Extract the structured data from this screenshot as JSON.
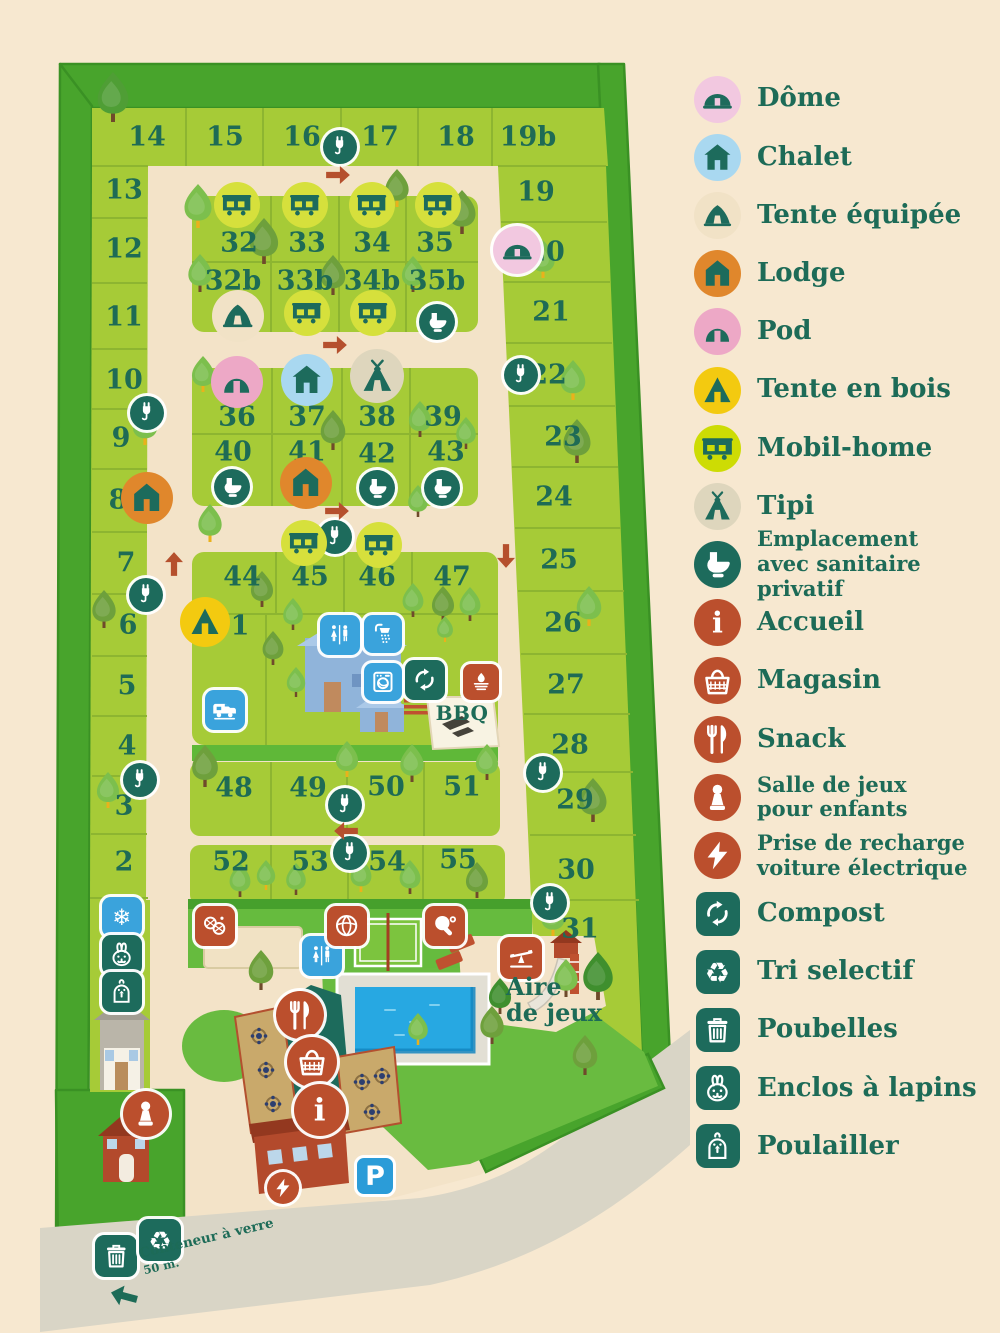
{
  "colors": {
    "page_bg": "#f7e8d0",
    "hedge": "#48a42c",
    "plot_green": "#a6cb37",
    "lawn": "#69bb40",
    "path": "#f3e3c8",
    "road": "#d9d5c6",
    "pool_water": "#27a8e2",
    "text_teal": "#1d6b57",
    "rust": "#bb4f2d",
    "teal_sign": "#1d6b5c",
    "blue_sign": "#3aa3dc"
  },
  "legend": {
    "items": [
      {
        "label": "Dôme",
        "icon": "dome-icon",
        "shape": "circle",
        "bg": "#f2c8e0",
        "fg": "#1d6b5c"
      },
      {
        "label": "Chalet",
        "icon": "chalet-icon",
        "shape": "circle",
        "bg": "#a9d8f0",
        "fg": "#1d6b5c"
      },
      {
        "label": "Tente équipée",
        "icon": "tent-icon",
        "shape": "circle",
        "bg": "#f1e2c6",
        "fg": "#1d6b5c"
      },
      {
        "label": "Lodge",
        "icon": "lodge-icon",
        "shape": "circle",
        "bg": "#e0872c",
        "fg": "#1d6b5c"
      },
      {
        "label": "Pod",
        "icon": "pod-icon",
        "shape": "circle",
        "bg": "#eda8c6",
        "fg": "#1d6b5c"
      },
      {
        "label": "Tente en bois",
        "icon": "wood-tent-icon",
        "shape": "circle",
        "bg": "#f3ca10",
        "fg": "#1d6b5c"
      },
      {
        "label": "Mobil-home",
        "icon": "mobil-home-icon",
        "shape": "circle",
        "bg": "#cddc04",
        "fg": "#1d6b5c"
      },
      {
        "label": "Tipi",
        "icon": "tipi-icon",
        "shape": "circle",
        "bg": "#ded6bd",
        "fg": "#1d6b5c"
      },
      {
        "label": "Emplacement avec sanitaire privatif",
        "lines": [
          "Emplacement",
          "avec sanitaire privatif"
        ],
        "icon": "toilet-icon",
        "shape": "circle",
        "bg": "#1d6b5c",
        "fg": "#ffffff"
      },
      {
        "label": "Accueil",
        "icon": "info-icon",
        "shape": "circle",
        "bg": "#bb4f2d",
        "fg": "#ffffff"
      },
      {
        "label": "Magasin",
        "icon": "basket-icon",
        "shape": "circle",
        "bg": "#bb4f2d",
        "fg": "#ffffff"
      },
      {
        "label": "Snack",
        "icon": "cutlery-icon",
        "shape": "circle",
        "bg": "#bb4f2d",
        "fg": "#ffffff"
      },
      {
        "label": "Salle de jeux pour enfants",
        "lines": [
          "Salle de jeux",
          "pour enfants"
        ],
        "icon": "pawn-icon",
        "shape": "circle",
        "bg": "#bb4f2d",
        "fg": "#ffffff"
      },
      {
        "label": "Prise de recharge voiture électrique",
        "lines": [
          "Prise de recharge",
          "voiture électrique"
        ],
        "icon": "lightning-icon",
        "shape": "circle",
        "bg": "#bb4f2d",
        "fg": "#ffffff"
      },
      {
        "label": "Compost",
        "icon": "compost-icon",
        "shape": "square",
        "bg": "#1d6b5c",
        "fg": "#ffffff"
      },
      {
        "label": "Tri selectif",
        "icon": "recycle-icon",
        "shape": "square",
        "bg": "#1d6b5c",
        "fg": "#ffffff"
      },
      {
        "label": "Poubelles",
        "icon": "trash-icon",
        "shape": "square",
        "bg": "#1d6b5c",
        "fg": "#ffffff"
      },
      {
        "label": "Enclos à lapins",
        "icon": "rabbit-icon",
        "shape": "square",
        "bg": "#1d6b5c",
        "fg": "#ffffff"
      },
      {
        "label": "Poulailler",
        "icon": "chicken-icon",
        "shape": "square",
        "bg": "#1d6b5c",
        "fg": "#ffffff"
      }
    ]
  },
  "map": {
    "labels": {
      "playground_line1": "Aire",
      "playground_line2": "de jeux",
      "bbq": "BBQ",
      "parking": "P",
      "glass_line1": "Conteneur à verre",
      "glass_line2": "50 m."
    },
    "plots": [
      {
        "n": "14",
        "x": 147,
        "y": 137
      },
      {
        "n": "15",
        "x": 225,
        "y": 137
      },
      {
        "n": "16",
        "x": 302,
        "y": 137
      },
      {
        "n": "17",
        "x": 380,
        "y": 137
      },
      {
        "n": "18",
        "x": 456,
        "y": 137
      },
      {
        "n": "19b",
        "x": 528,
        "y": 137
      },
      {
        "n": "13",
        "x": 124,
        "y": 190
      },
      {
        "n": "12",
        "x": 124,
        "y": 249
      },
      {
        "n": "11",
        "x": 124,
        "y": 317
      },
      {
        "n": "10",
        "x": 124,
        "y": 380
      },
      {
        "n": "9",
        "x": 121,
        "y": 438
      },
      {
        "n": "8",
        "x": 118,
        "y": 500
      },
      {
        "n": "7",
        "x": 126,
        "y": 563
      },
      {
        "n": "6",
        "x": 128,
        "y": 625
      },
      {
        "n": "5",
        "x": 127,
        "y": 686
      },
      {
        "n": "4",
        "x": 127,
        "y": 746
      },
      {
        "n": "3",
        "x": 124,
        "y": 806
      },
      {
        "n": "2",
        "x": 124,
        "y": 862
      },
      {
        "n": "19",
        "x": 536,
        "y": 192
      },
      {
        "n": "20",
        "x": 546,
        "y": 252
      },
      {
        "n": "21",
        "x": 551,
        "y": 312
      },
      {
        "n": "22",
        "x": 548,
        "y": 375
      },
      {
        "n": "23",
        "x": 563,
        "y": 437
      },
      {
        "n": "24",
        "x": 554,
        "y": 497
      },
      {
        "n": "25",
        "x": 559,
        "y": 560
      },
      {
        "n": "26",
        "x": 563,
        "y": 623
      },
      {
        "n": "27",
        "x": 566,
        "y": 685
      },
      {
        "n": "28",
        "x": 570,
        "y": 745
      },
      {
        "n": "29",
        "x": 575,
        "y": 800
      },
      {
        "n": "30",
        "x": 576,
        "y": 870
      },
      {
        "n": "31",
        "x": 580,
        "y": 929
      },
      {
        "n": "32",
        "x": 239,
        "y": 243
      },
      {
        "n": "33",
        "x": 307,
        "y": 243
      },
      {
        "n": "34",
        "x": 372,
        "y": 243
      },
      {
        "n": "35",
        "x": 435,
        "y": 243
      },
      {
        "n": "32b",
        "x": 233,
        "y": 281
      },
      {
        "n": "33b",
        "x": 305,
        "y": 281
      },
      {
        "n": "34b",
        "x": 372,
        "y": 281
      },
      {
        "n": "35b",
        "x": 437,
        "y": 281
      },
      {
        "n": "36",
        "x": 237,
        "y": 417
      },
      {
        "n": "37",
        "x": 307,
        "y": 417
      },
      {
        "n": "38",
        "x": 377,
        "y": 417
      },
      {
        "n": "39",
        "x": 443,
        "y": 417
      },
      {
        "n": "40",
        "x": 233,
        "y": 452
      },
      {
        "n": "41",
        "x": 307,
        "y": 452
      },
      {
        "n": "42",
        "x": 377,
        "y": 454
      },
      {
        "n": "43",
        "x": 446,
        "y": 452
      },
      {
        "n": "44",
        "x": 242,
        "y": 577
      },
      {
        "n": "45",
        "x": 310,
        "y": 577
      },
      {
        "n": "46",
        "x": 377,
        "y": 577
      },
      {
        "n": "47",
        "x": 452,
        "y": 577
      },
      {
        "n": "1",
        "x": 240,
        "y": 626
      },
      {
        "n": "48",
        "x": 234,
        "y": 788
      },
      {
        "n": "49",
        "x": 308,
        "y": 788
      },
      {
        "n": "50",
        "x": 386,
        "y": 787
      },
      {
        "n": "51",
        "x": 462,
        "y": 787
      },
      {
        "n": "52",
        "x": 231,
        "y": 862
      },
      {
        "n": "53",
        "x": 310,
        "y": 862
      },
      {
        "n": "54",
        "x": 387,
        "y": 862
      },
      {
        "n": "55",
        "x": 458,
        "y": 860
      }
    ],
    "feature_types": {
      "ev": {
        "name": "ev-charger-icon",
        "icon": "plug-icon",
        "shape": "circle",
        "bg": "#1d6b5c",
        "fg": "#ffffff",
        "size": 34,
        "ring": true
      },
      "dome": {
        "name": "dome-icon",
        "icon": "dome-icon",
        "shape": "circle",
        "bg": "#f2c8e0",
        "fg": "#1d6b5c",
        "size": 48,
        "ring": true
      },
      "pod": {
        "name": "pod-icon",
        "icon": "pod-icon",
        "shape": "circle",
        "bg": "#eda8c6",
        "fg": "#1d6b5c",
        "size": 52
      },
      "chalet": {
        "name": "chalet-icon",
        "icon": "chalet-icon",
        "shape": "circle",
        "bg": "#a9d8f0",
        "fg": "#1d6b5c",
        "size": 52
      },
      "tipi": {
        "name": "tipi-icon",
        "icon": "tipi-icon",
        "shape": "circle",
        "bg": "#ded6bd",
        "fg": "#1d6b5c",
        "size": 54
      },
      "tent": {
        "name": "tente-equipee-icon",
        "icon": "tent-icon",
        "shape": "circle",
        "bg": "#f1e2c6",
        "fg": "#1d6b5c",
        "size": 52
      },
      "lodge": {
        "name": "lodge-icon",
        "icon": "lodge-icon",
        "shape": "circle",
        "bg": "#e0872c",
        "fg": "#1d6b5c",
        "size": 52
      },
      "woodtent": {
        "name": "tente-en-bois-icon",
        "icon": "wood-tent-icon",
        "shape": "circle",
        "bg": "#f3ca10",
        "fg": "#1d6b5c",
        "size": 50
      },
      "mobilhome": {
        "name": "mobil-home-icon",
        "icon": "mobil-home-icon",
        "shape": "circle",
        "bg": "#d6e03c",
        "fg": "#1d6b5c",
        "size": 46
      },
      "toilet": {
        "name": "sanitaire-privatif-icon",
        "icon": "toilet-icon",
        "shape": "circle",
        "bg": "#1d6b5c",
        "fg": "#ffffff",
        "size": 36,
        "ring": true
      },
      "wc": {
        "name": "wc-icon",
        "icon": "wc-icon",
        "shape": "square",
        "bg": "#3aa3dc",
        "fg": "#ffffff",
        "size": 40,
        "ring": true
      },
      "shower": {
        "name": "shower-icon",
        "icon": "shower-icon",
        "shape": "square",
        "bg": "#3aa3dc",
        "fg": "#ffffff",
        "size": 38,
        "ring": true
      },
      "washer": {
        "name": "laundry-icon",
        "icon": "washer-icon",
        "shape": "square",
        "bg": "#3aa3dc",
        "fg": "#ffffff",
        "size": 38,
        "ring": true
      },
      "camper": {
        "name": "camper-service-icon",
        "icon": "camper-icon",
        "shape": "square",
        "bg": "#3aa3dc",
        "fg": "#ffffff",
        "size": 40,
        "ring": true
      },
      "snowflake": {
        "name": "ice-icon",
        "icon": "snowflake-icon",
        "shape": "square",
        "bg": "#3aa3dc",
        "fg": "#ffffff",
        "size": 40,
        "ring": true
      },
      "compost": {
        "name": "compost-icon",
        "icon": "compost-icon",
        "shape": "square",
        "bg": "#1d6b5c",
        "fg": "#ffffff",
        "size": 40,
        "ring": true
      },
      "rabbit": {
        "name": "enclos-lapins-icon",
        "icon": "rabbit-icon",
        "shape": "square",
        "bg": "#1d6b5c",
        "fg": "#ffffff",
        "size": 40,
        "ring": true
      },
      "chicken": {
        "name": "poulailler-icon",
        "icon": "chicken-icon",
        "shape": "square",
        "bg": "#1d6b5c",
        "fg": "#ffffff",
        "size": 40,
        "ring": true
      },
      "trash": {
        "name": "poubelles-icon",
        "icon": "trash-icon",
        "shape": "square",
        "bg": "#1d6b5c",
        "fg": "#ffffff",
        "size": 42,
        "ring": true
      },
      "recycle": {
        "name": "tri-selectif-icon",
        "icon": "recycle-icon",
        "shape": "square",
        "bg": "#1d6b5c",
        "fg": "#ffffff",
        "size": 42,
        "ring": true
      },
      "bbq": {
        "name": "bbq-icon",
        "icon": "bbq-icon",
        "shape": "square",
        "bg": "#bb4f2d",
        "fg": "#ffffff",
        "size": 36,
        "ring": true
      },
      "petanque": {
        "name": "petanque-icon",
        "icon": "petanque-icon",
        "shape": "square",
        "bg": "#bb4f2d",
        "fg": "#ffffff",
        "size": 40,
        "ring": true
      },
      "volleyball": {
        "name": "volleyball-icon",
        "icon": "volleyball-icon",
        "shape": "square",
        "bg": "#bb4f2d",
        "fg": "#ffffff",
        "size": 40,
        "ring": true
      },
      "pingpong": {
        "name": "ping-pong-icon",
        "icon": "pingpong-icon",
        "shape": "square",
        "bg": "#bb4f2d",
        "fg": "#ffffff",
        "size": 40,
        "ring": true
      },
      "seesaw": {
        "name": "playground-icon",
        "icon": "seesaw-icon",
        "shape": "square",
        "bg": "#bb4f2d",
        "fg": "#ffffff",
        "size": 42,
        "ring": true
      },
      "snack": {
        "name": "snack-icon",
        "icon": "cutlery-icon",
        "shape": "circle",
        "bg": "#bb4f2d",
        "fg": "#ffffff",
        "size": 48,
        "ring": true
      },
      "shop": {
        "name": "magasin-icon",
        "icon": "basket-icon",
        "shape": "circle",
        "bg": "#bb4f2d",
        "fg": "#ffffff",
        "size": 50,
        "ring": true
      },
      "info": {
        "name": "accueil-icon",
        "icon": "info-icon",
        "shape": "circle",
        "bg": "#bb4f2d",
        "fg": "#ffffff",
        "size": 52,
        "ring": true
      },
      "pawn": {
        "name": "salle-de-jeux-icon",
        "icon": "pawn-icon",
        "shape": "circle",
        "bg": "#bb4f2d",
        "fg": "#ffffff",
        "size": 46,
        "ring": true
      },
      "bolt": {
        "name": "recharge-icon",
        "icon": "lightning-icon",
        "shape": "circle",
        "bg": "#bb4f2d",
        "fg": "#ffffff",
        "size": 32,
        "ring": true
      },
      "arrow": {
        "name": "direction-arrow-icon",
        "icon": "arrow-icon",
        "shape": "plain",
        "fg": "#b5502d",
        "size": 30
      },
      "glassarrow": {
        "name": "glass-container-arrow-icon",
        "icon": "arrow-icon",
        "shape": "plain",
        "fg": "#1d6b57",
        "size": 34
      }
    },
    "features": [
      {
        "t": "ev",
        "x": 340,
        "y": 147
      },
      {
        "t": "ev",
        "x": 147,
        "y": 413
      },
      {
        "t": "ev",
        "x": 146,
        "y": 595
      },
      {
        "t": "ev",
        "x": 140,
        "y": 780
      },
      {
        "t": "ev",
        "x": 521,
        "y": 375
      },
      {
        "t": "ev",
        "x": 543,
        "y": 773
      },
      {
        "t": "ev",
        "x": 550,
        "y": 903
      },
      {
        "t": "ev",
        "x": 335,
        "y": 537
      },
      {
        "t": "ev",
        "x": 345,
        "y": 805
      },
      {
        "t": "ev",
        "x": 350,
        "y": 853
      },
      {
        "t": "dome",
        "x": 517,
        "y": 250
      },
      {
        "t": "pod",
        "x": 237,
        "y": 382
      },
      {
        "t": "chalet",
        "x": 307,
        "y": 380
      },
      {
        "t": "tipi",
        "x": 377,
        "y": 376
      },
      {
        "t": "tent",
        "x": 238,
        "y": 316
      },
      {
        "t": "lodge",
        "x": 147,
        "y": 498
      },
      {
        "t": "lodge",
        "x": 306,
        "y": 483
      },
      {
        "t": "woodtent",
        "x": 205,
        "y": 622
      },
      {
        "t": "mobilhome",
        "x": 237,
        "y": 205
      },
      {
        "t": "mobilhome",
        "x": 305,
        "y": 205
      },
      {
        "t": "mobilhome",
        "x": 372,
        "y": 205
      },
      {
        "t": "mobilhome",
        "x": 438,
        "y": 205
      },
      {
        "t": "mobilhome",
        "x": 307,
        "y": 313
      },
      {
        "t": "mobilhome",
        "x": 373,
        "y": 313
      },
      {
        "t": "mobilhome",
        "x": 304,
        "y": 543
      },
      {
        "t": "mobilhome",
        "x": 379,
        "y": 545
      },
      {
        "t": "toilet",
        "x": 437,
        "y": 322
      },
      {
        "t": "toilet",
        "x": 232,
        "y": 487
      },
      {
        "t": "toilet",
        "x": 377,
        "y": 488
      },
      {
        "t": "toilet",
        "x": 442,
        "y": 488
      },
      {
        "t": "wc",
        "x": 340,
        "y": 635
      },
      {
        "t": "wc",
        "x": 322,
        "y": 956
      },
      {
        "t": "shower",
        "x": 383,
        "y": 634
      },
      {
        "t": "washer",
        "x": 383,
        "y": 682
      },
      {
        "t": "camper",
        "x": 225,
        "y": 710
      },
      {
        "t": "compost",
        "x": 425,
        "y": 680
      },
      {
        "t": "bbq",
        "x": 481,
        "y": 682
      },
      {
        "t": "snowflake",
        "x": 122,
        "y": 917
      },
      {
        "t": "rabbit",
        "x": 122,
        "y": 955
      },
      {
        "t": "chicken",
        "x": 122,
        "y": 992
      },
      {
        "t": "petanque",
        "x": 215,
        "y": 926
      },
      {
        "t": "volleyball",
        "x": 347,
        "y": 926
      },
      {
        "t": "pingpong",
        "x": 445,
        "y": 926
      },
      {
        "t": "seesaw",
        "x": 521,
        "y": 958
      },
      {
        "t": "snack",
        "x": 300,
        "y": 1015
      },
      {
        "t": "shop",
        "x": 312,
        "y": 1062
      },
      {
        "t": "info",
        "x": 320,
        "y": 1110
      },
      {
        "t": "pawn",
        "x": 146,
        "y": 1114
      },
      {
        "t": "bolt",
        "x": 283,
        "y": 1188
      },
      {
        "t": "trash",
        "x": 116,
        "y": 1256
      },
      {
        "t": "recycle",
        "x": 160,
        "y": 1240
      },
      {
        "t": "arrow",
        "x": 338,
        "y": 175,
        "rot": 0
      },
      {
        "t": "arrow",
        "x": 335,
        "y": 345,
        "rot": 0
      },
      {
        "t": "arrow",
        "x": 337,
        "y": 511,
        "rot": 0
      },
      {
        "t": "arrow",
        "x": 174,
        "y": 564,
        "rot": -90
      },
      {
        "t": "arrow",
        "x": 506,
        "y": 556,
        "rot": 90
      },
      {
        "t": "arrow",
        "x": 346,
        "y": 831,
        "rot": 180
      },
      {
        "t": "glassarrow",
        "x": 124,
        "y": 1296,
        "rot": 195
      }
    ]
  }
}
